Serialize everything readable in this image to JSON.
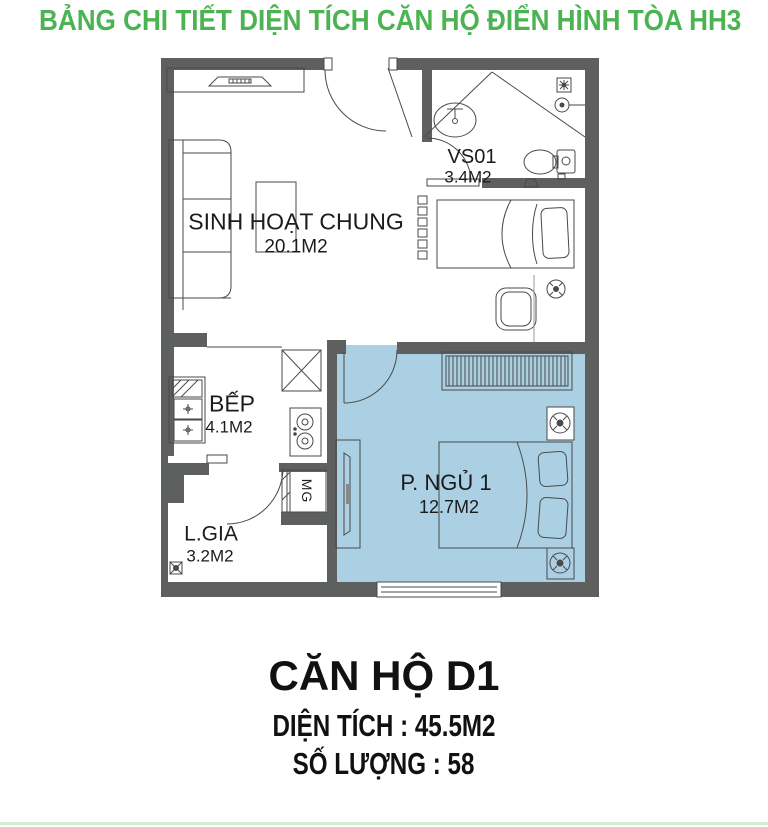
{
  "title": "BẢNG CHI TIẾT DIỆN TÍCH CĂN HỘ ĐIỂN HÌNH TÒA HH3",
  "colors": {
    "title_green": "#4bb352",
    "wall_gray": "#5e5f5f",
    "highlight_room_blue": "#abd0e4",
    "line_gray": "#4a4a4a",
    "bottom_bar_green": "#d4ecd4"
  },
  "rooms": {
    "living": {
      "name": "SINH HOẠT CHUNG",
      "area": "20.1M2"
    },
    "bathroom": {
      "name": "VS01",
      "area": "3.4M2"
    },
    "kitchen": {
      "name": "BẾP",
      "area": "4.1M2"
    },
    "loggia": {
      "name": "L.GIA",
      "area": "3.2M2"
    },
    "bedroom1": {
      "name": "P. NGỦ 1",
      "area": "12.7M2"
    }
  },
  "labels": {
    "washing_machine": "MG"
  },
  "icons": [
    "ceiling-fan-icon",
    "vent-icon",
    "shower-head-icon",
    "floor-drain-icon"
  ],
  "footer": {
    "apartment_name": "CĂN HỘ D1",
    "area_line": "DIỆN TÍCH : 45.5M2",
    "quantity_line": "SỐ LƯỢNG : 58"
  }
}
